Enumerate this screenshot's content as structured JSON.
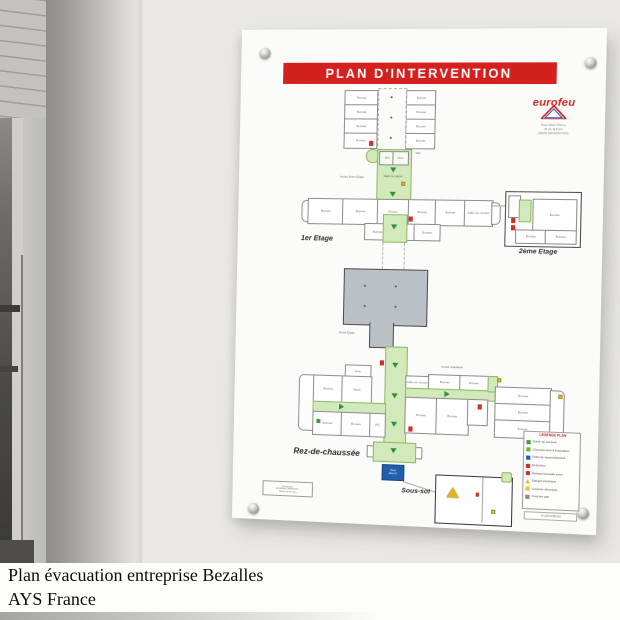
{
  "colors": {
    "banner_red": "#d5211e",
    "evac_green": "#d2e9bb",
    "sign_blue": "#1f5fae",
    "hazard_yellow": "#e6c52e",
    "extinguisher_red": "#d03026",
    "atelier_gray": "#bac0c6"
  },
  "panel": {
    "title": "PLAN D'INTERVENTION",
    "brand": {
      "name": "eurofeu",
      "address_lines": [
        "Rue Albert Rémy",
        "ZI de la Fust",
        "28250 SENONCHES"
      ]
    },
    "floors": {
      "first": "1er Etage",
      "second": "2ème Etage",
      "ground": "Rez-de-chaussée",
      "basement": "Sous-sol"
    },
    "labels": {
      "bureau": "Bureau",
      "salle_pause": "Salle de pause",
      "salle_reunion": "Salle de réunion",
      "photoc": "Photoc.",
      "wc": "WC",
      "vest": "Vest.",
      "san": "San.",
      "stock": "Stock",
      "acces_2eme": "Accès 2ème Etage",
      "acces_etage": "Accès Etage",
      "acces_chaufferie": "Accès chaufferie"
    },
    "blue_sign": "Vous êtes ici",
    "legend": {
      "title": "LEGENDE PLAN",
      "items": [
        "Sortie de secours",
        "Cheminement d'évacuation",
        "Point de rassemblement",
        "Extincteur",
        "Robinet incendie armé",
        "Danger électrique",
        "Coupure électrique",
        "Coupure gaz"
      ],
      "reference": "07-1137-DSM-001"
    },
    "stamp_lines": [
      "Réalisation",
      "EUROFEU SERVICES",
      "28250 Senonches"
    ]
  },
  "caption": {
    "line1": "Plan évacuation entreprise Bezalles",
    "line2": "AYS France"
  }
}
